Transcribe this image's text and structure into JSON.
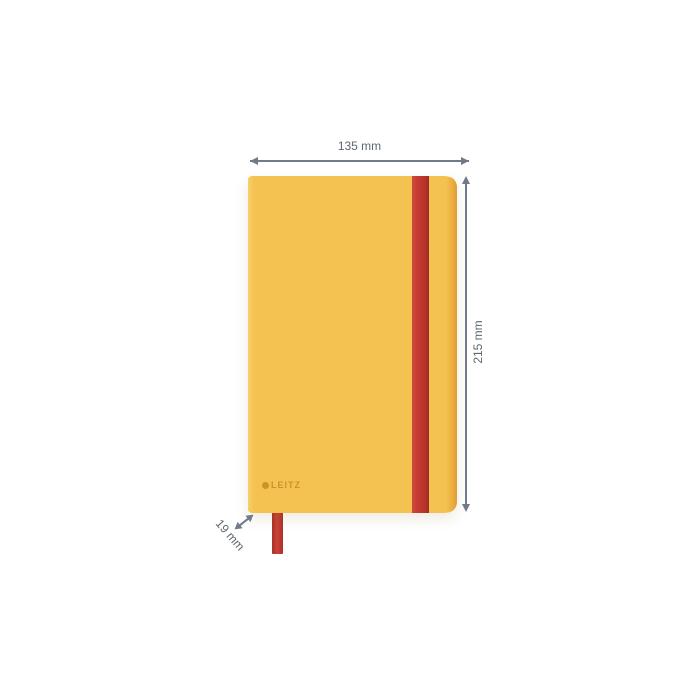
{
  "product": {
    "brand": "LEITZ",
    "item": "notebook with elastic band and ribbon bookmark",
    "cover_color": "#F4C250",
    "band_color": "#C23B32",
    "ribbon_color": "#C7443A"
  },
  "dimensions": {
    "width": {
      "label": "135 mm"
    },
    "height": {
      "label": "215 mm"
    },
    "depth": {
      "label": "19 mm"
    }
  },
  "annotation_style": {
    "line_color": "#6F7B89",
    "text_color": "#5D6771"
  }
}
